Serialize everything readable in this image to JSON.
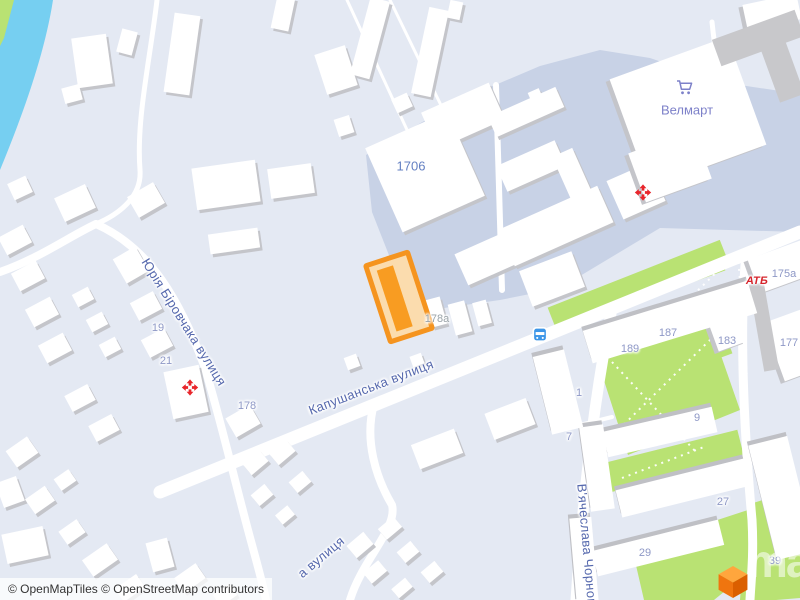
{
  "attribution": {
    "text": "© OpenMapTiles © OpenStreetMap contributors"
  },
  "watermark": {
    "text": "maptiler"
  },
  "streets": {
    "kapushanska": "Капушанська вулиця",
    "birovchaka": "Юрія Біровчака вулиця",
    "chornovola": "В'ячеслава Чорновола",
    "partial": "а вулиця"
  },
  "pois": {
    "velmart": "Велмарт",
    "atb": "АТБ"
  },
  "house_numbers": {
    "n1706": "1706",
    "n178a": "178а",
    "n178": "178",
    "n19": "19",
    "n21": "21",
    "n175a": "175а",
    "n177": "177",
    "n183": "183",
    "n187": "187",
    "n189": "189",
    "n1": "1",
    "n7": "7",
    "n9": "9",
    "n27": "27",
    "n29": "29",
    "n39": "39"
  },
  "colors": {
    "background": "#e4e9f3",
    "water": "#76cff1",
    "park_green": "#b9e273",
    "campus_area": "#c8d2e6",
    "road": "#ffffff",
    "building": "#ffffff",
    "building_wall": "#c4c5ca",
    "gray_building": "#c8c8cb",
    "selection_border": "#f5941f",
    "selection_fill": "#fbdcae",
    "selection_core": "#f89c22",
    "street_label": "#5568ad",
    "house_number": "#8e98c6",
    "poi_label": "#7d81c9",
    "atb_red": "#d6252c",
    "pharmacy_red": "#e8252b",
    "bus_blue": "#3d96e8",
    "logo_orange": "#f07000"
  }
}
